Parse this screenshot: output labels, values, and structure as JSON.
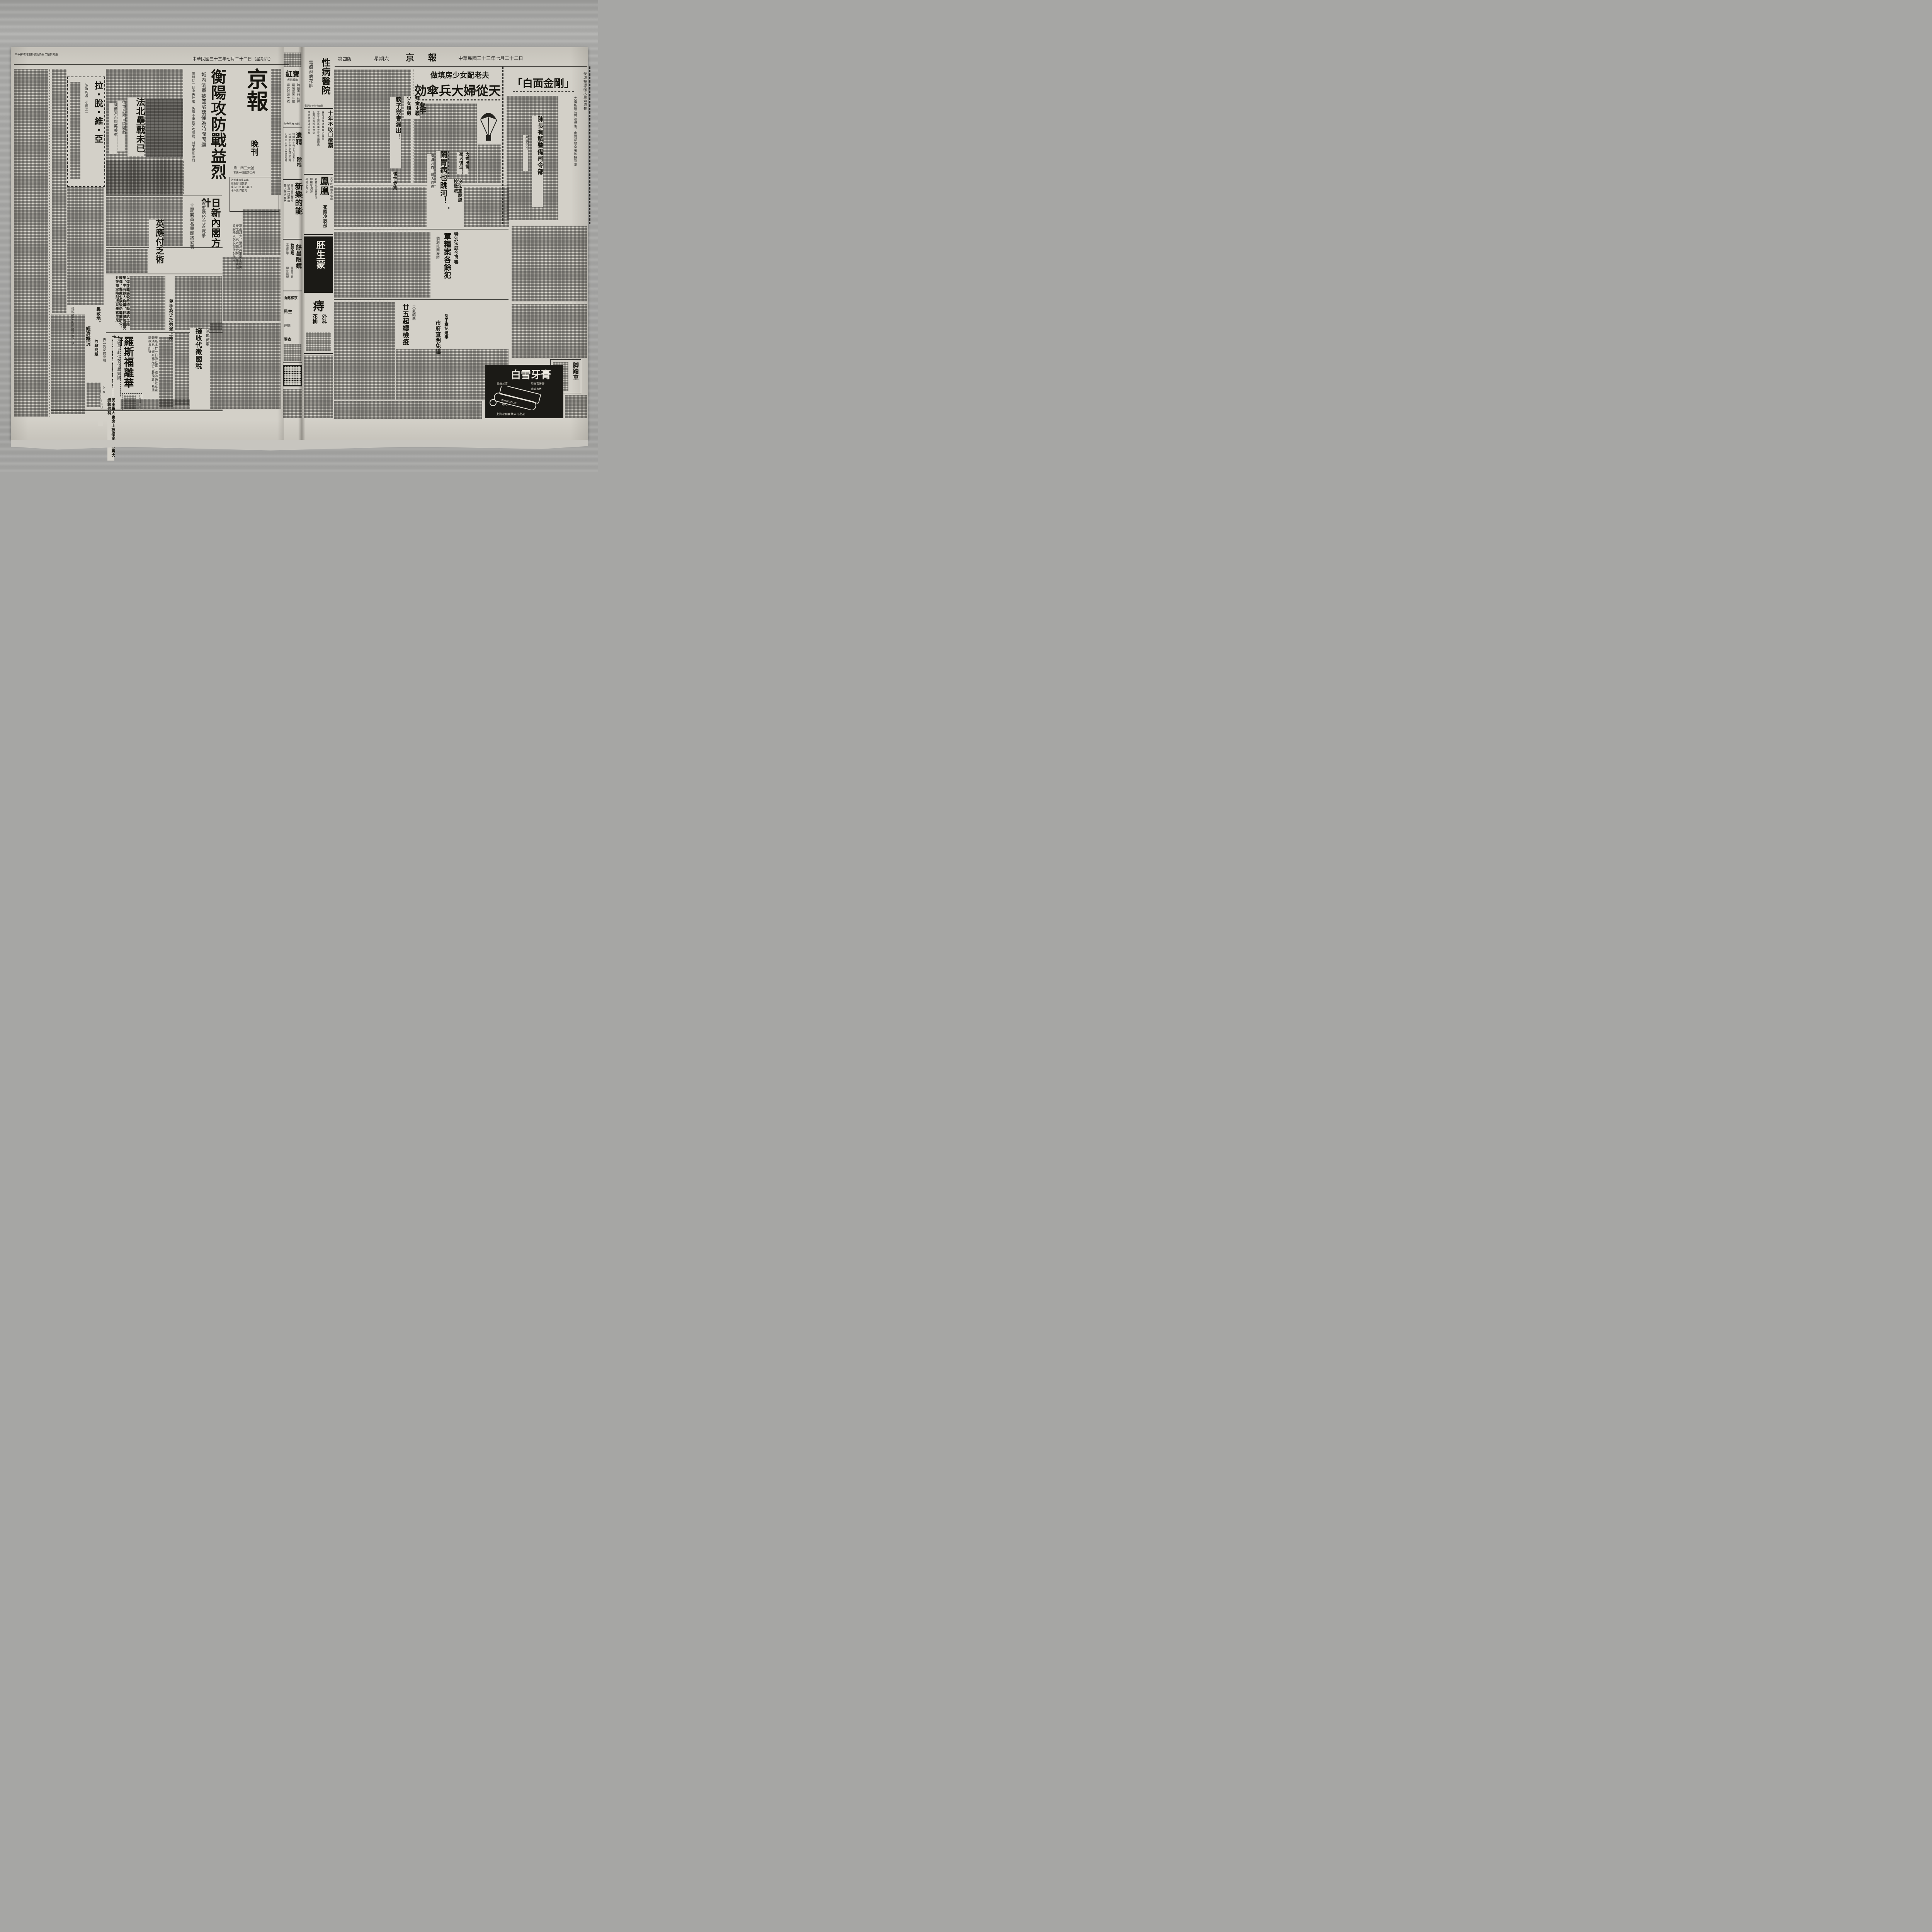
{
  "left": {
    "postal_note": "中華郵政特准掛號認為第二類新聞紙",
    "date_line": "中華民國三十三年七月二十二日（星期六）",
    "masthead": {
      "title": "京報",
      "edition": "晚刊",
      "issue_no": "第一四三六號",
      "price": "零售一張國幣二元",
      "info_lines": [
        "社址南京朱雀路",
        "編輯部 營業部",
        "廣告刊例 每行每日",
        "十八元 四百元"
      ]
    },
    "hengyang": {
      "headline": "衡陽攻防戰益烈",
      "kicker": "城內渝軍被圍陷落僅為時間問題",
      "lead": "廣州廿一日中央社電：衡陽市街雙方攻防戰，刻下更形激烈"
    },
    "fabei": {
      "headline": "法北壘戰未已",
      "kicker1": "德軍於兩日間毀敵",
      "kicker2": "威爾河西岸英美軍"
    },
    "latvia": {
      "headline": "拉・脫・維・亞",
      "kicker": "波羅的海三小國之一",
      "crosshead1": "集散地。",
      "crosshead2": "經濟概況",
      "lead": "拉脫維亞的國民經濟，以"
    },
    "cabinet": {
      "headline": "日新內閣方針",
      "kicker1": "置重點於完遂戰爭",
      "kicker2": "全部閣員名單即將發表"
    },
    "copper_note": "銅產減少，預測其軍需上所需要之銅，已以鋁代替，生產局會謂能以鋁長期代銅使用。",
    "england": {
      "headline": "英應付乏術"
    },
    "hitler": {
      "bold_lead": "以爆炸圖謀殺希特勒總統之結果，中有數人負傷，但總統僅受輕傷，傷處包紮後仍繼續辦公，并在預定時刻接見墨索里尼",
      "kicker": "兇手為史托勞堡上校"
    },
    "turkey": {
      "headline": "土耳其國會作短期休會",
      "kicker": "輿論仍反對參戰",
      "dateline": "里斯本二十二日"
    },
    "roosevelt": {
      "headline": "羅斯福離華府",
      "kicker": "是否已赴倫敦似屬疑問",
      "lead": "里斯本廿一日斯社電：據海通社華盛頓消息：羅斯福是否已赴倫敦，為此間政界所疑",
      "note": "民主黨大會席上被指定為該黨大總統候補",
      "marks": "××"
    },
    "tax": {
      "headline": "接收代徵國稅",
      "kicker": "渝偽徵軍"
    },
    "crosshead_interior": "內政問題",
    "notice_date": "七月廿一日"
  },
  "gutter": {
    "hongbao": {
      "title": "紅寶",
      "sub": "呢絨服飾",
      "lines": [
        "聘請專門技師",
        "精製高等洋服",
        "婦女時裝大衣"
      ],
      "footer": "各色男女袍料"
    },
    "yijing": {
      "title": "遺精",
      "title2": "除根",
      "lines": [
        "特貼四十元下月售五十",
        "函購加十元上海江西路",
        "北京天安堂南京國府路"
      ]
    },
    "xinle": {
      "title": "新樂的能",
      "lines": [
        "男用白色藥片",
        "解決一切淋病",
        "各大藥房有售"
      ]
    },
    "yuchang": {
      "title": "餘昌眼鏡",
      "tag": "救配戴",
      "lines": [
        "視覺不良",
        "直接影響",
        "間接障礙"
      ]
    },
    "small_ads": [
      "由滬移京",
      "民生",
      "經銷",
      "雨衣"
    ],
    "xingbing": {
      "title": "性病醫院",
      "services": "電療淋病花柳",
      "phone": "電話鼓樓六十四號"
    },
    "shinian": {
      "title": "十年不收口瘡藥",
      "lines": [
        "專治潰爛流膿難治毒瘡",
        "三日全愈新藥更靈每瓶四元",
        "上海三馬路蓋世堂",
        "南京國府路過街樓"
      ]
    },
    "fenghuang": {
      "title": "鳳凰",
      "sub": "花園冷飲部",
      "tag": "夏令晚間消暑佳處",
      "lines": [
        "著名鳳凰鮮桔汁",
        "檸檬冰淇淋",
        "荷蘭水汽水"
      ]
    },
    "peisheng": {
      "title": "胚生蒙"
    },
    "zhi": {
      "title": "痔",
      "sub1": "外科",
      "sub2": "花柳"
    }
  },
  "right": {
    "header": {
      "edition": "第四版",
      "weekday": "星期六",
      "paper": "京 報",
      "date": "中華民國三十三年七月二十二日"
    },
    "parachute": {
      "kicker": "做填房少女配老夫",
      "headline": "効傘兵大婦從天降",
      "bold1": "拜金主義",
      "bold2": "少女填房"
    },
    "baimian": {
      "headline": "「白面金剛」",
      "sub": "陳長有解警備司令部",
      "side": "死裏逃生",
      "edge": "受虐被逐控夫重婚遺棄",
      "lead": "大毒販陳長有被捕後，由首都警察署移解到京"
    },
    "bangzi": {
      "headline": "膀子豈會漏出！"
    },
    "chronic": "慢性赤痢",
    "dafu": {
      "sub1": "大婦出現",
      "sub2": "死人復生"
    },
    "naowei": {
      "headline": "鬧胃病也跳河！",
      "kicker": "秦淮河內一婦人自盡",
      "bold": "沒法擺脫誣控做賊"
    },
    "junliang": {
      "headline": "軍糧案各餘犯",
      "kicker": "特別法庭今再審",
      "sub": "個別訊問歷時"
    },
    "jianyi": {
      "headline": "廿五起總檢疫",
      "kicker": "天氣酷熱"
    },
    "shifu": {
      "headline": "市府查明免議",
      "kicker": "岳子章記過事"
    },
    "bike_ad": {
      "title": "脚踏車"
    },
    "snow_ad": {
      "brand": "白雪牙膏",
      "line1": "用白雪牙膏",
      "line2": "齒白如雪",
      "line3": "處處有售",
      "company": "上海永和實業公司出品",
      "tube": "WHITE SNOW"
    }
  }
}
